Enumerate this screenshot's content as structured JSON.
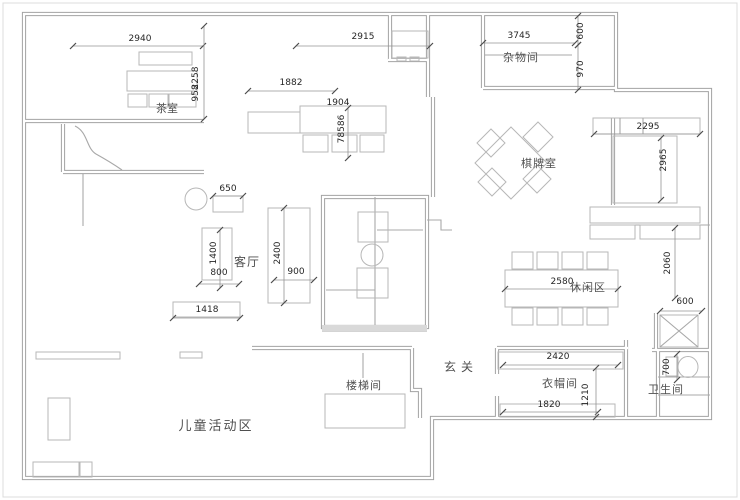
{
  "plan": {
    "canvas": {
      "width": 740,
      "height": 500,
      "background": "#ffffff"
    },
    "colors": {
      "wall": "#a2a2a2",
      "furniture": "#b7b7b7",
      "dimension_line": "#949494",
      "dimension_text": "#262626",
      "room_label": "#4f4f4f"
    },
    "rooms": [
      {
        "id": "tea-room",
        "label": "茶室",
        "x": 167,
        "y": 112,
        "size": 11,
        "ls": 0
      },
      {
        "id": "storage-room",
        "label": "杂物间",
        "x": 521,
        "y": 61,
        "size": 11,
        "ls": 1
      },
      {
        "id": "chess-room",
        "label": "棋牌室",
        "x": 539,
        "y": 167,
        "size": 11,
        "ls": 1
      },
      {
        "id": "living-room",
        "label": "客厅",
        "x": 247,
        "y": 266,
        "size": 12,
        "ls": 1
      },
      {
        "id": "leisure-area",
        "label": "休闲区",
        "x": 588,
        "y": 291,
        "size": 11,
        "ls": 1
      },
      {
        "id": "entry",
        "label": "玄关",
        "x": 461,
        "y": 371,
        "size": 12,
        "ls": 5
      },
      {
        "id": "stairwell",
        "label": "楼梯间",
        "x": 364,
        "y": 389,
        "size": 11,
        "ls": 1
      },
      {
        "id": "cloakroom",
        "label": "衣帽间",
        "x": 560,
        "y": 387,
        "size": 11,
        "ls": 1
      },
      {
        "id": "bathroom",
        "label": "卫生间",
        "x": 666,
        "y": 393,
        "size": 11,
        "ls": 1
      },
      {
        "id": "kids-area",
        "label": "儿童活动区",
        "x": 216,
        "y": 430,
        "size": 13,
        "ls": 2
      }
    ],
    "dimensions": [
      {
        "id": "dim-2940",
        "value": "2940",
        "x": 140,
        "y": 41,
        "rot": 0,
        "line": [
          73,
          46,
          203,
          46
        ]
      },
      {
        "id": "dim-2258",
        "value": "2258",
        "x": 198,
        "y": 78,
        "rot": -90,
        "line": [
          204,
          26,
          204,
          119
        ]
      },
      {
        "id": "dim-958",
        "value": "958",
        "x": 198,
        "y": 93,
        "rot": -90,
        "line": null
      },
      {
        "id": "dim-2915",
        "value": "2915",
        "x": 363,
        "y": 39,
        "rot": 0,
        "line": [
          296,
          46,
          430,
          46
        ]
      },
      {
        "id": "dim-3745",
        "value": "3745",
        "x": 519,
        "y": 38,
        "rot": 0,
        "line": [
          483,
          43,
          575,
          43
        ]
      },
      {
        "id": "dim-600-top",
        "value": "600",
        "x": 583,
        "y": 31,
        "rot": -90,
        "line": [
          578,
          16,
          578,
          45
        ]
      },
      {
        "id": "dim-970",
        "value": "970",
        "x": 583,
        "y": 69,
        "rot": -90,
        "line": [
          578,
          45,
          578,
          90
        ]
      },
      {
        "id": "dim-1882",
        "value": "1882",
        "x": 291,
        "y": 85,
        "rot": 0,
        "line": [
          248,
          91,
          335,
          91
        ]
      },
      {
        "id": "dim-1904",
        "value": "1904",
        "x": 338,
        "y": 105,
        "rot": 0,
        "line": null
      },
      {
        "id": "dim-78586",
        "value": "78586",
        "x": 344,
        "y": 129,
        "rot": -90,
        "line": [
          348,
          108,
          348,
          158
        ]
      },
      {
        "id": "dim-2295",
        "value": "2295",
        "x": 648,
        "y": 129,
        "rot": 0,
        "line": [
          594,
          134,
          700,
          134
        ]
      },
      {
        "id": "dim-2965",
        "value": "2965",
        "x": 666,
        "y": 160,
        "rot": -90,
        "line": [
          661,
          138,
          661,
          200
        ]
      },
      {
        "id": "dim-650",
        "value": "650",
        "x": 228,
        "y": 191,
        "rot": 0,
        "line": [
          213,
          196,
          243,
          196
        ]
      },
      {
        "id": "dim-1400",
        "value": "1400",
        "x": 216,
        "y": 253,
        "rot": -90,
        "line": [
          220,
          230,
          220,
          288
        ]
      },
      {
        "id": "dim-800",
        "value": "800",
        "x": 219,
        "y": 275,
        "rot": 0,
        "line": [
          199,
          284,
          239,
          284
        ]
      },
      {
        "id": "dim-2400",
        "value": "2400",
        "x": 280,
        "y": 253,
        "rot": -90,
        "line": [
          284,
          208,
          284,
          303
        ]
      },
      {
        "id": "dim-900",
        "value": "900",
        "x": 296,
        "y": 274,
        "rot": 0,
        "line": [
          274,
          280,
          314,
          280
        ]
      },
      {
        "id": "dim-1418",
        "value": "1418",
        "x": 207,
        "y": 312,
        "rot": 0,
        "line": [
          173,
          318,
          240,
          318
        ]
      },
      {
        "id": "dim-2580",
        "value": "2580",
        "x": 562,
        "y": 284,
        "rot": 0,
        "line": [
          505,
          289,
          618,
          289
        ]
      },
      {
        "id": "dim-2060",
        "value": "2060",
        "x": 670,
        "y": 263,
        "rot": -90,
        "line": [
          675,
          228,
          675,
          298
        ]
      },
      {
        "id": "dim-600-shaft",
        "value": "600",
        "x": 685,
        "y": 304,
        "rot": 0,
        "line": [
          660,
          311,
          702,
          311
        ]
      },
      {
        "id": "dim-700",
        "value": "700",
        "x": 669,
        "y": 367,
        "rot": -90,
        "line": [
          677,
          354,
          677,
          380
        ]
      },
      {
        "id": "dim-2420",
        "value": "2420",
        "x": 558,
        "y": 359,
        "rot": 0,
        "line": [
          503,
          365,
          618,
          365
        ]
      },
      {
        "id": "dim-1820",
        "value": "1820",
        "x": 549,
        "y": 407,
        "rot": 0,
        "line": [
          503,
          412,
          598,
          412
        ]
      },
      {
        "id": "dim-1210",
        "value": "1210",
        "x": 588,
        "y": 395,
        "rot": -90,
        "line": [
          596,
          368,
          596,
          417
        ]
      }
    ]
  }
}
